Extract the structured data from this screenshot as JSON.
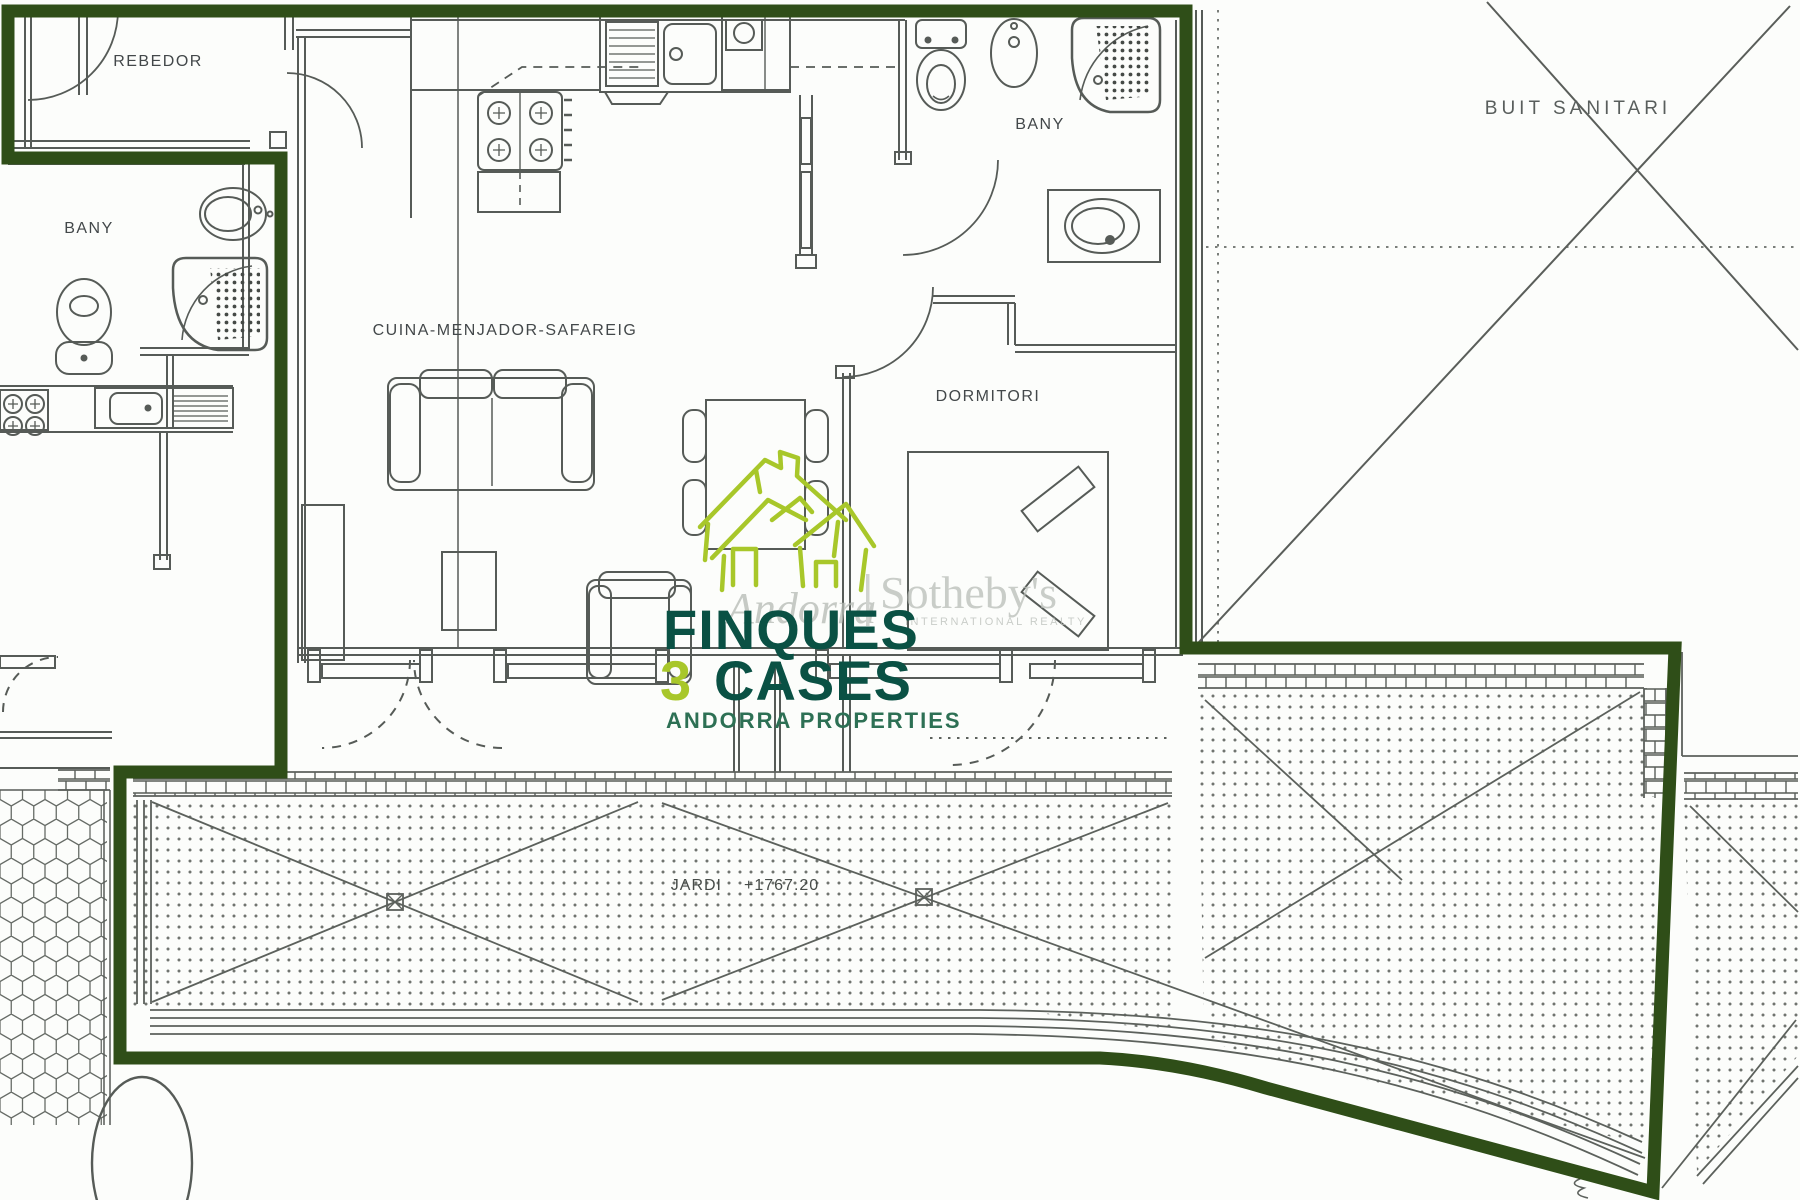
{
  "document": {
    "type": "apartment-floor-plan"
  },
  "rooms": {
    "rebedor": "REBEDOR",
    "bany_left": "BANY",
    "cuina": "CUINA-MENJADOR-SAFAREIG",
    "bany_right": "BANY",
    "dormitori": "DORMITORI",
    "buit_sanitari": "BUIT SANITARI",
    "jardi": "JARDI",
    "jardi_elevation": "+1767.20"
  },
  "logo": {
    "line1": "FINQUES",
    "line2_number": "3",
    "line2_word": "CASES",
    "tagline": "ANDORRA PROPERTIES"
  },
  "watermark": {
    "brand_left": "Andorra",
    "brand_right": "Sotheby's",
    "subtitle": "INTERNATIONAL REALTY"
  },
  "colors": {
    "boundary_green": "#2f4e18",
    "logo_dark_green": "#0a5144",
    "logo_lime": "#a8c72a",
    "tagline_green": "#2d7054",
    "line_gray": "#565b57",
    "watermark_gray": "#b5bab4",
    "paper": "#fcfdfb"
  }
}
